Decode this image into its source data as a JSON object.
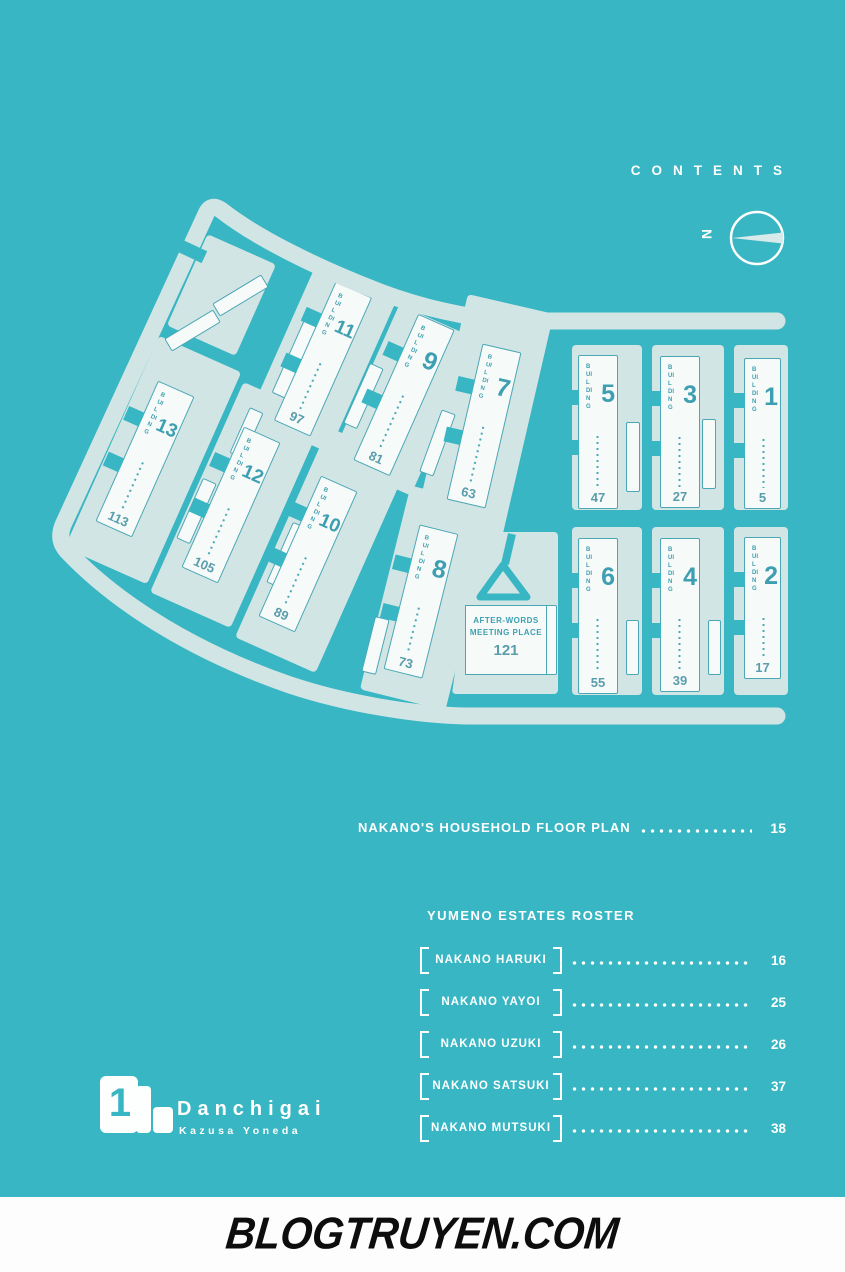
{
  "colors": {
    "background": "#38b6c3",
    "block_pad": "#d2e5e5",
    "building_fill": "#f6faf9",
    "building_line": "#4ba7b6",
    "text_teal": "#3d9fb1",
    "white": "#ffffff",
    "footer_ink": "#0d0d0d"
  },
  "header": {
    "contents_label": "CONTENTS"
  },
  "compass": {
    "north_label": "N"
  },
  "map": {
    "building_word": "BUILDING",
    "buildings": [
      {
        "num": "1",
        "page": "5"
      },
      {
        "num": "2",
        "page": "17"
      },
      {
        "num": "3",
        "page": "27"
      },
      {
        "num": "4",
        "page": "39"
      },
      {
        "num": "5",
        "page": "47"
      },
      {
        "num": "6",
        "page": "55"
      },
      {
        "num": "7",
        "page": "63"
      },
      {
        "num": "8",
        "page": "73"
      },
      {
        "num": "9",
        "page": "81"
      },
      {
        "num": "10",
        "page": "89"
      },
      {
        "num": "11",
        "page": "97"
      },
      {
        "num": "12",
        "page": "105"
      },
      {
        "num": "13",
        "page": "113"
      }
    ],
    "meeting_place": {
      "line1": "AFTER-WORDS",
      "line2": "MEETING PLACE",
      "page": "121"
    }
  },
  "toc": {
    "floor_plan": {
      "label": "NAKANO'S HOUSEHOLD FLOOR PLAN",
      "page": "15"
    },
    "roster": {
      "title": "YUMENO ESTATES ROSTER",
      "items": [
        {
          "name": "NAKANO HARUKI",
          "page": "16"
        },
        {
          "name": "NAKANO YAYOI",
          "page": "25"
        },
        {
          "name": "NAKANO UZUKI",
          "page": "26"
        },
        {
          "name": "NAKANO SATSUKI",
          "page": "37"
        },
        {
          "name": "NAKANO MUTSUKI",
          "page": "38"
        }
      ]
    }
  },
  "logo": {
    "volume": "1",
    "title": "Danchigai",
    "author": "Kazusa Yoneda"
  },
  "footer": {
    "site": "BLOGTRUYEN.COM"
  }
}
